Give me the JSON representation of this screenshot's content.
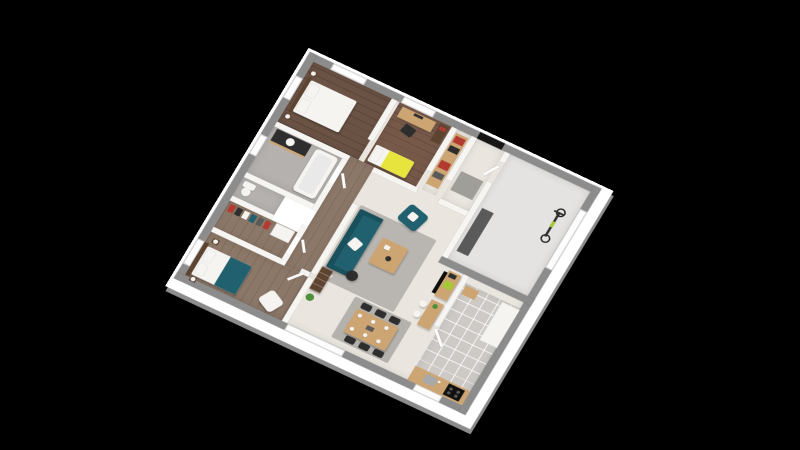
{
  "scene": {
    "type": "3d-isometric-floor-plan-render",
    "background": "#000000",
    "visible_text": "none",
    "view": "top-down axonometric, plan rotated with top corner up, black letterbox background"
  },
  "colors": {
    "background": "#000000",
    "slab_white": "#ffffff",
    "exterior_wall": "#8c8c8c",
    "interior_wall": "#f6f5f2",
    "window_white": "#fdfdfd",
    "black_door": "#161616",
    "floor_living": "#eae6df",
    "floor_wood_dark": "#6a5244",
    "floor_wood_mid": "#77594a",
    "floor_wood_gray": "#8c7868",
    "floor_bath": "#b4b1ae",
    "floor_tile": "#cdcac6",
    "floor_garage": "#e4e3e1",
    "rug_gray": "#b9b6b1",
    "rug_gray2": "#b5b2ad",
    "doormat_gray": "#a09e99",
    "accent_teal": "#21606f",
    "accent_teal_dark": "#1a4f5c",
    "accent_yellow": "#e8e43e",
    "accent_lime": "#a6c838",
    "accent_red": "#b23a30",
    "wood_light": "#cda573",
    "wood_dark": "#5d4430",
    "dark_furniture": "#2e2e2e",
    "white_furniture": "#f6f4f0",
    "bench_gray": "#5a5a5a",
    "steel_gray": "#a9a9a9",
    "plant_green": "#4e8f3a"
  },
  "rooms": [
    {
      "id": "bedroom-1",
      "floor": "dark wood planks",
      "furniture": [
        "double-bed-white",
        "nightstand-x2",
        "ball-lamp-x2",
        "window-x2"
      ]
    },
    {
      "id": "bedroom-2",
      "floor": "wood planks",
      "furniture": [
        "desk",
        "monitor",
        "desk-chair",
        "single-bed-yellow-blanket",
        "bookshelf",
        "window"
      ]
    },
    {
      "id": "storage-closet",
      "floor": "light",
      "furniture": [
        "shelving-with-red-boxes"
      ]
    },
    {
      "id": "entrance-hall",
      "floor": "light",
      "furniture": [
        "black-front-door",
        "gray-doormat"
      ]
    },
    {
      "id": "garage",
      "floor": "concrete gray",
      "furniture": [
        "bicycle",
        "workbench",
        "white-garage-door"
      ]
    },
    {
      "id": "bathroom",
      "floor": "gray",
      "furniture": [
        "bathtub",
        "dark-vanity-with-sink",
        "window"
      ]
    },
    {
      "id": "wc",
      "floor": "gray",
      "furniture": [
        "toilet"
      ]
    },
    {
      "id": "dressing",
      "floor": "gray wood",
      "furniture": [
        "hanging-clothes-rail",
        "white-shelf"
      ]
    },
    {
      "id": "master-bedroom",
      "floor": "gray wood",
      "furniture": [
        "double-bed-teal-blanket",
        "nightstand-x2",
        "ball-lamp-x2",
        "white-armchair",
        "window"
      ]
    },
    {
      "id": "living-room",
      "floor": "beige",
      "furniture": [
        "teal-sofa",
        "teal-armchair",
        "wood-coffee-table",
        "gray-rug",
        "dark-side-table",
        "white-pouf",
        "tall-bookshelf",
        "green-plant",
        "tv-desk-with-monitor",
        "lime-chair",
        "bar-counter",
        "white-stool-x2"
      ]
    },
    {
      "id": "dining-area",
      "floor": "beige",
      "furniture": [
        "gray-rug",
        "wood-dining-table",
        "dark-chair-x6",
        "white-plates-x6",
        "sliding-bay-window"
      ]
    },
    {
      "id": "kitchen",
      "floor": "gray tiles",
      "furniture": [
        "wood-counter",
        "sink",
        "black-cooktop",
        "white-tall-cabinets",
        "window"
      ]
    }
  ]
}
